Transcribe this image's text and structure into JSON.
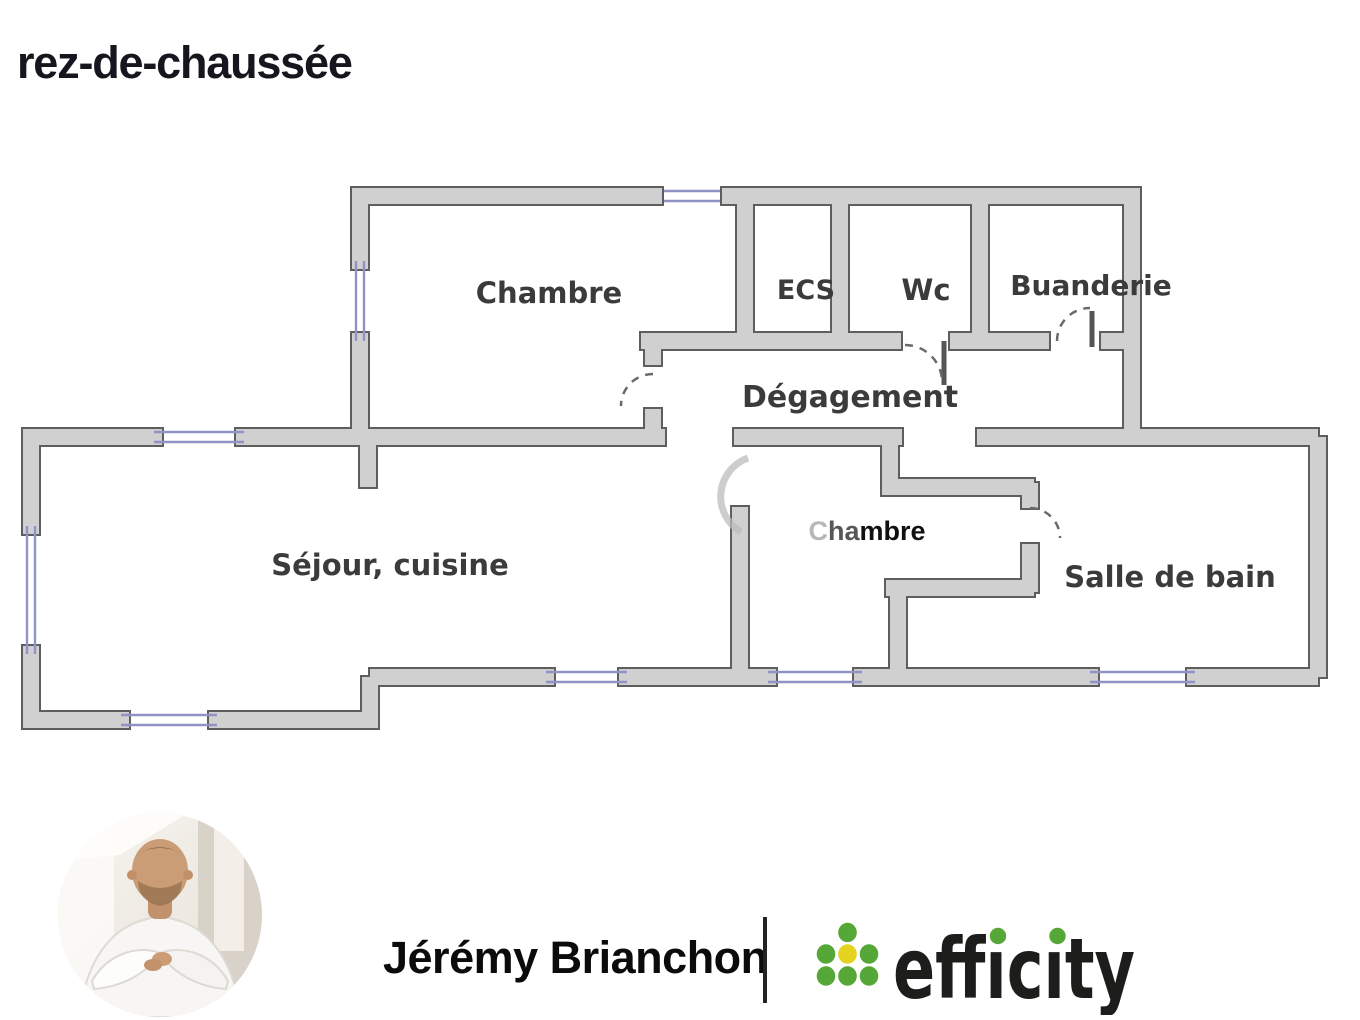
{
  "page": {
    "title": "rez-de-chaussée"
  },
  "floor_plan": {
    "name": "ground-floor-plan",
    "rooms": [
      {
        "id": "chambre-1",
        "label": "Chambre"
      },
      {
        "id": "ecs",
        "label": "ECS"
      },
      {
        "id": "wc",
        "label": "Wc"
      },
      {
        "id": "buanderie",
        "label": "Buanderie"
      },
      {
        "id": "degagement",
        "label": "Dégagement"
      },
      {
        "id": "chambre-2",
        "label": "Chambre",
        "label_parts": [
          "C",
          "ha",
          "mbre"
        ]
      },
      {
        "id": "sejour-cuisine",
        "label": "Séjour, cuisine"
      },
      {
        "id": "salle-de-bain",
        "label": "Salle de bain"
      }
    ],
    "colors": {
      "wall_fill": "#d0d0d0",
      "wall_outline": "#5e5e5e",
      "window": "#9193c6",
      "label_text": "#3b3b3b"
    }
  },
  "footer": {
    "agent_name": "Jérémy Brianchon",
    "brand_name": "efficity",
    "brand_wordmark_display": "effıcıty",
    "brand_colors": {
      "green": "#55a838",
      "yellow": "#e5d322",
      "text": "#1d1d1b"
    }
  }
}
